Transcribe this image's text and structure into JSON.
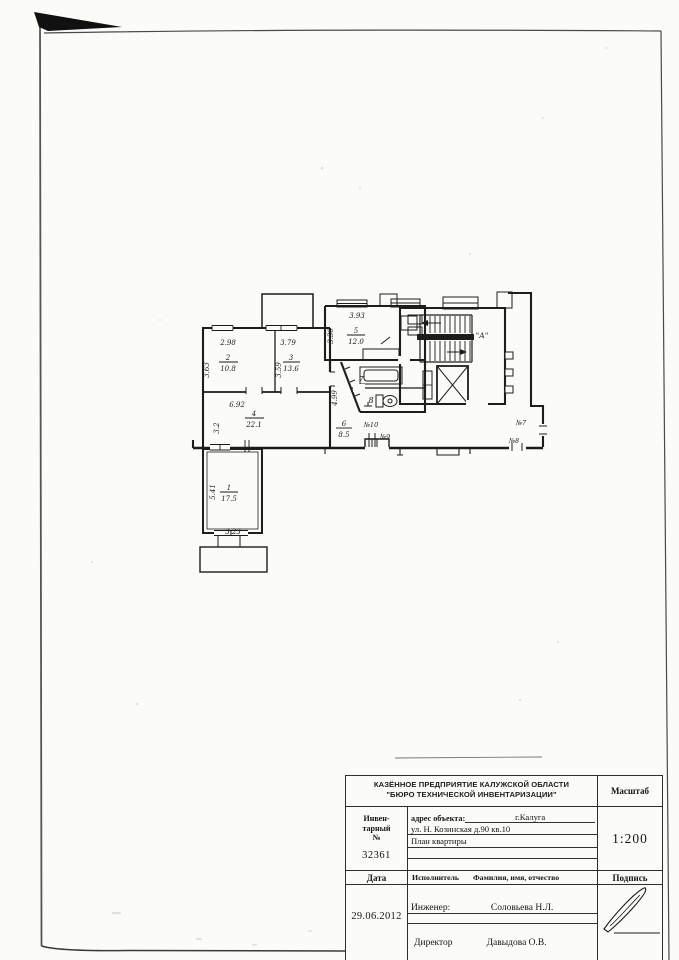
{
  "page": {
    "background": "#fbfbf8"
  },
  "plan": {
    "labels": {
      "stair": "\"А\"",
      "room1_num": "1",
      "room1_area": "17.5",
      "room1_w": "3.23",
      "room1_h": "5.41",
      "room2_num": "2",
      "room2_area": "10.8",
      "room2_w": "2.98",
      "room2_h": "3.63",
      "room3_num": "3",
      "room3_area": "13.6",
      "room3_w": "3.79",
      "room3_h": "3.59",
      "room4_num": "4",
      "room4_area": "22.1",
      "room4_w": "6.92",
      "room4_h": "3.2",
      "room5_num": "5",
      "room5_area": "12.0",
      "room5_w": "3.93",
      "room5_h": "3.30",
      "room6_num": "6",
      "room6_area": "8.5",
      "room7_num": "7",
      "room8_num": "8",
      "hall_dim": "4.99",
      "door10": "№10",
      "door9": "№9",
      "door7": "№7",
      "door8": "№8"
    }
  },
  "title_block": {
    "org_line1": "КАЗЁННОЕ ПРЕДПРИЯТИЕ КАЛУЖСКОЙ ОБЛАСТИ",
    "org_line2": "\"БЮРО ТЕХНИЧЕСКОЙ ИНВЕНТАРИЗАЦИИ\"",
    "scale_label": "Масштаб",
    "scale_value": "1:200",
    "inv_line1": "Инвен-",
    "inv_line2": "тарный",
    "inv_line3": "№",
    "inventory_number": "32361",
    "address_label": "адрес  объекта:",
    "address_city": "г.Калуга",
    "address_street": "ул. Н. Козинская д.90 кв.10",
    "doc_title": "План квартиры",
    "date_label": "Дата",
    "executor_label": "Исполнитель",
    "fio_label": "Фамилия, имя, отчество",
    "sign_label": "Подпись",
    "date_value": "29.06.2012",
    "engineer_label": "Инженер:",
    "engineer_name": "Соловьева Н.Л.",
    "director_label": "Директор",
    "director_name": "Давыдова О.В."
  }
}
